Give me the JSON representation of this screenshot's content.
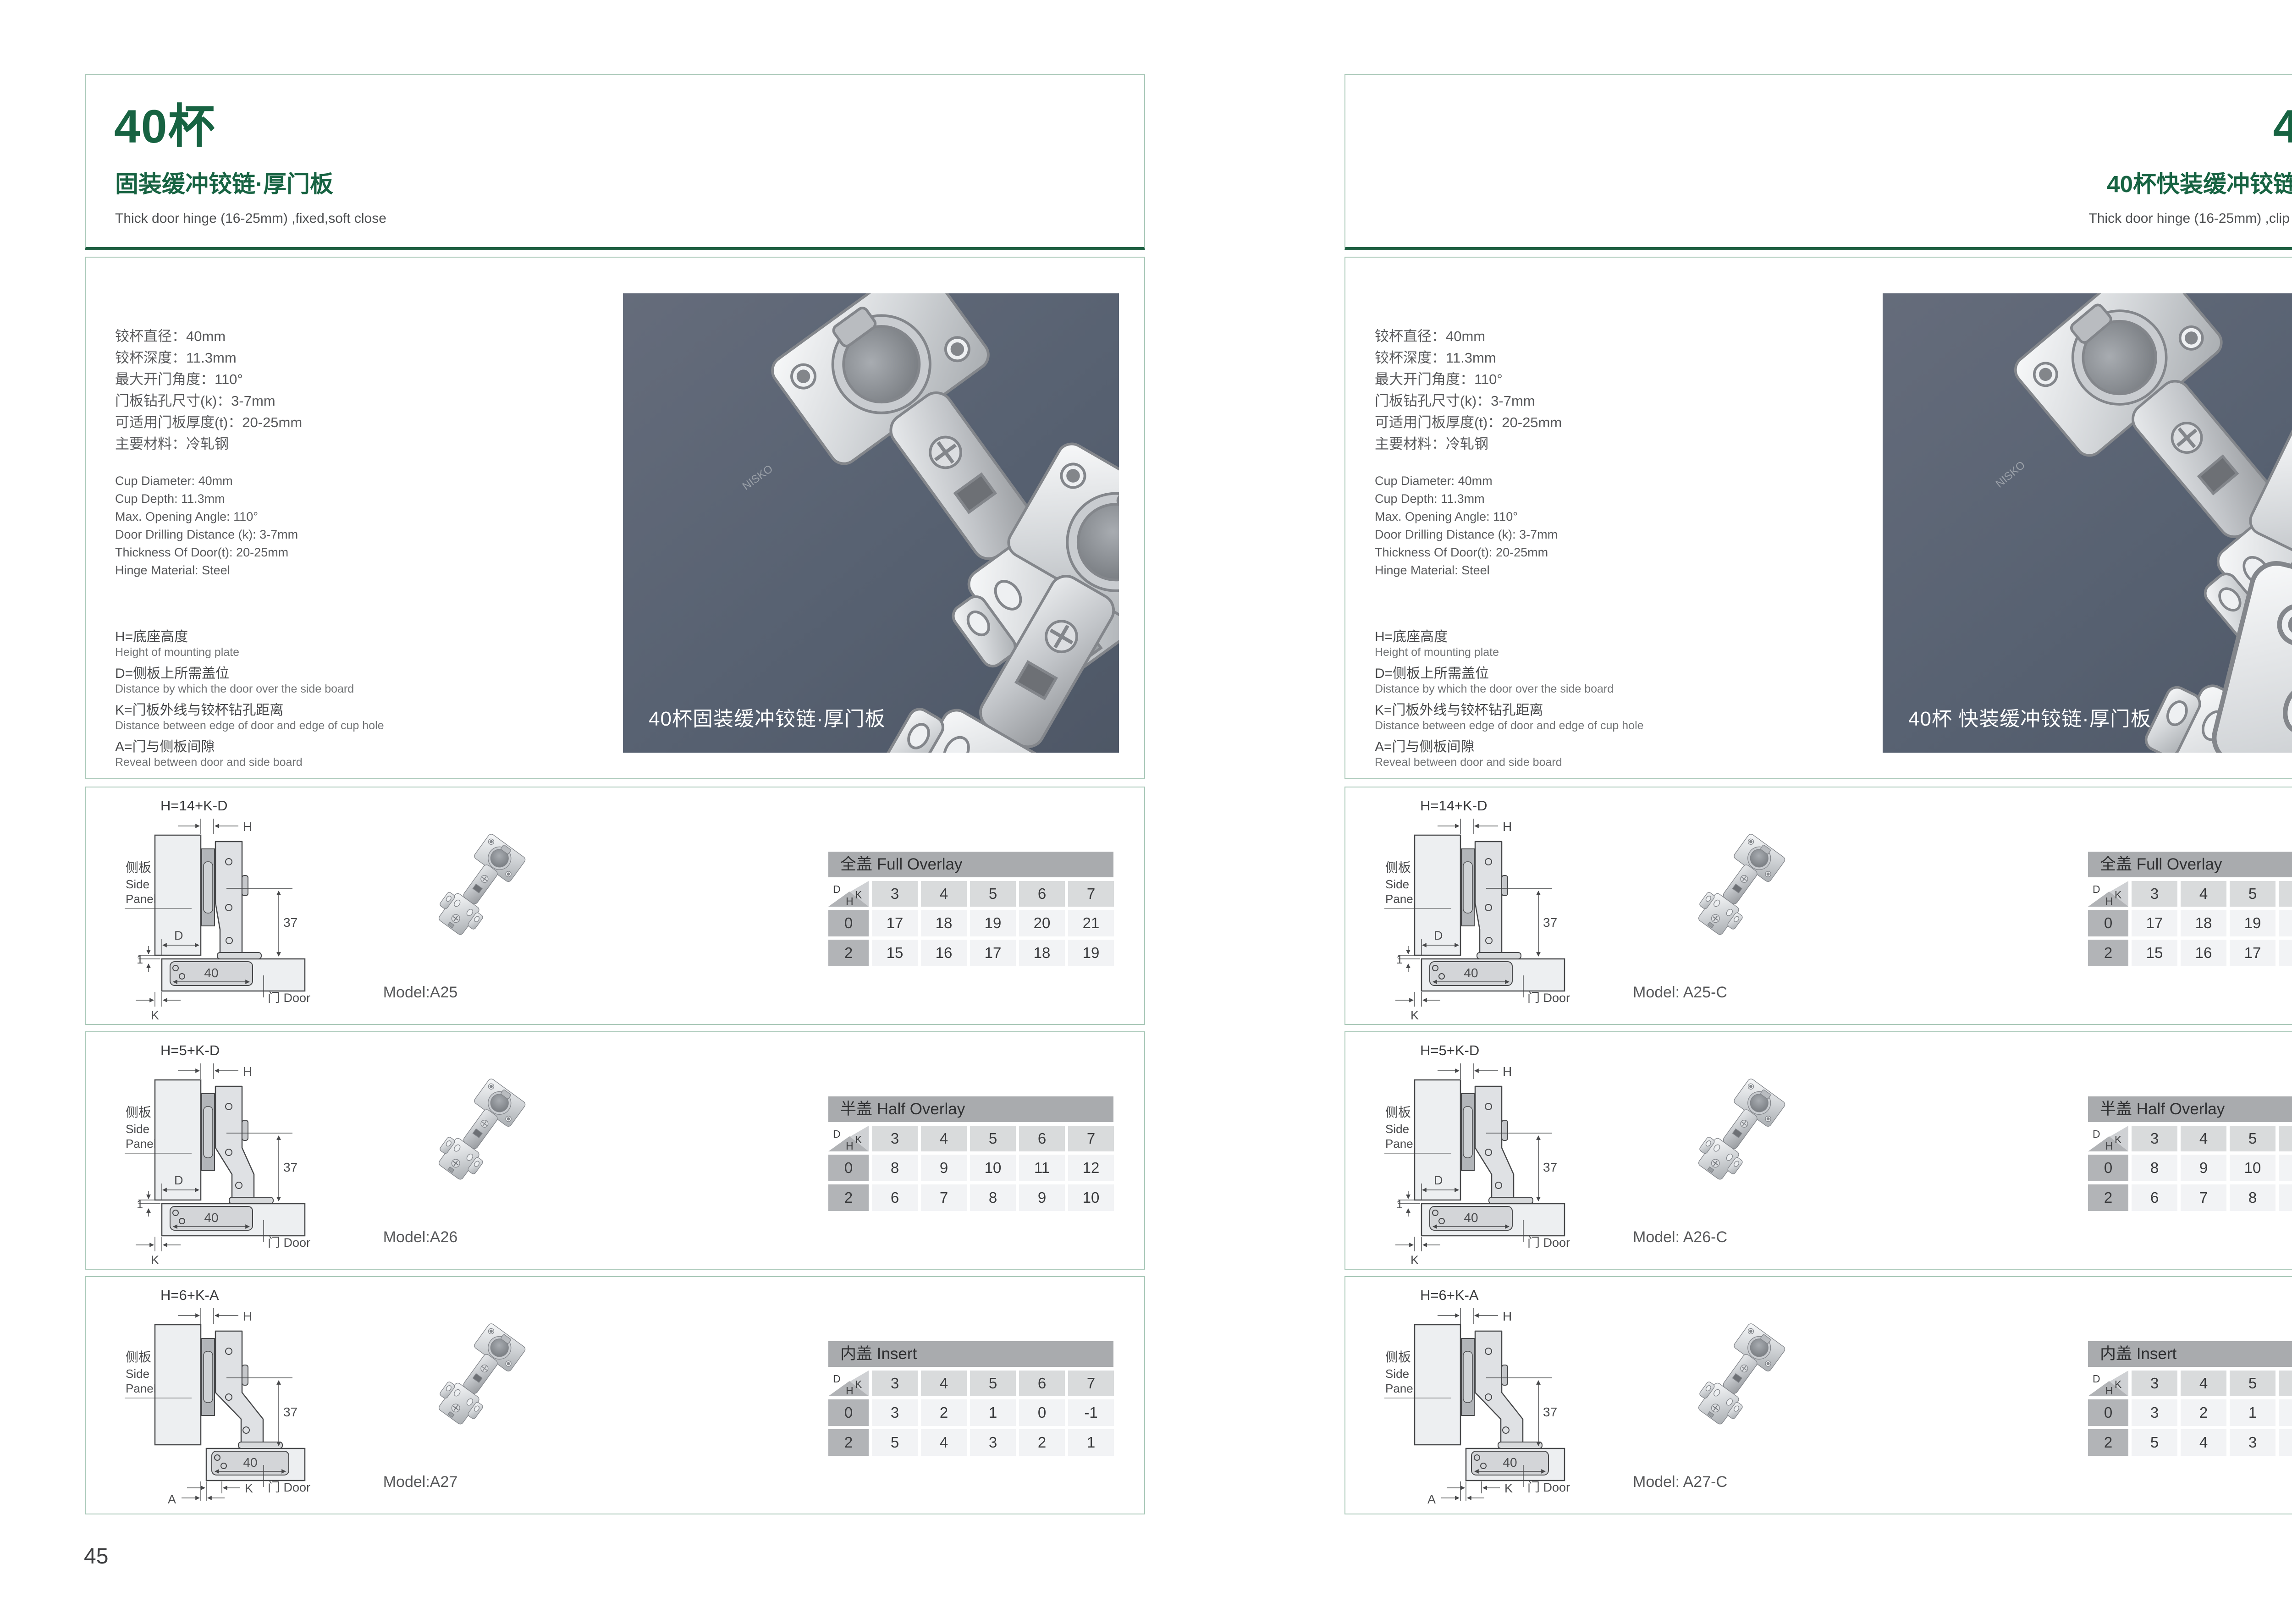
{
  "shared": {
    "brand_mark": "NISKO",
    "specs_zh": [
      "铰杯直径：40mm",
      "铰杯深度：11.3mm",
      "最大开门角度：110°",
      "门板钻孔尺寸(k)：3-7mm",
      "可适用门板厚度(t)：20-25mm",
      "主要材料：冷轧钢"
    ],
    "specs_en": [
      "Cup Diameter: 40mm",
      "Cup Depth: 11.3mm",
      "Max. Opening Angle: 110°",
      "Door Drilling Distance (k): 3-7mm",
      "Thickness Of Door(t): 20-25mm",
      "Hinge Material: Steel"
    ],
    "definitions": [
      {
        "zh": "H=底座高度",
        "en": "Height of mounting plate"
      },
      {
        "zh": "D=侧板上所需盖位",
        "en": "Distance by which the door over the side board"
      },
      {
        "zh": "K=门板外线与铰杯钻孔距离",
        "en": "Distance between edge of door and edge of cup hole"
      },
      {
        "zh": "A=门与侧板间隙",
        "en": "Reveal between door and side board"
      }
    ],
    "diagram": {
      "formulas": [
        "H=14+K-D",
        "H=5+K-D",
        "H=6+K-A"
      ],
      "side_panel_zh": "侧板",
      "side_panel_en1": "Side",
      "side_panel_en2": "Panel",
      "door_label": "门 Door",
      "h": "H",
      "d": "D",
      "k": "K",
      "a": "A",
      "dim37": "37",
      "dim40": "40",
      "dim1": "1"
    },
    "corner": {
      "d": "D",
      "k": "K",
      "h": "H"
    },
    "tables": [
      {
        "title": "全盖 Full Overlay",
        "k_values": [
          "3",
          "4",
          "5",
          "6",
          "7"
        ],
        "rows": [
          [
            "0",
            "17",
            "18",
            "19",
            "20",
            "21"
          ],
          [
            "2",
            "15",
            "16",
            "17",
            "18",
            "19"
          ]
        ]
      },
      {
        "title": "半盖 Half Overlay",
        "k_values": [
          "3",
          "4",
          "5",
          "6",
          "7"
        ],
        "rows": [
          [
            "0",
            "8",
            "9",
            "10",
            "11",
            "12"
          ],
          [
            "2",
            "6",
            "7",
            "8",
            "9",
            "10"
          ]
        ]
      },
      {
        "title": "内盖 Insert",
        "k_values": [
          "3",
          "4",
          "5",
          "6",
          "7"
        ],
        "rows": [
          [
            "0",
            "3",
            "2",
            "1",
            "0",
            "-1"
          ],
          [
            "2",
            "5",
            "4",
            "3",
            "2",
            "1"
          ]
        ]
      }
    ]
  },
  "left_page": {
    "title": "40杯",
    "subtitle": "固装缓冲铰链·厚门板",
    "tagline": "Thick door hinge (16-25mm) ,fixed,soft close",
    "photo_caption": "40杯固装缓冲铰链·厚门板",
    "models": [
      "Model:A25",
      "Model:A26",
      "Model:A27"
    ],
    "page_number": "45"
  },
  "right_page": {
    "title": "40杯",
    "subtitle": "40杯快装缓冲铰链·厚门板",
    "tagline": "Thick door hinge (16-25mm) ,clip on ,soft close",
    "photo_caption": "40杯 快装缓冲铰链·厚门板",
    "models": [
      "Model: A25-C",
      "Model: A26-C",
      "Model: A27-C"
    ],
    "page_number": "46"
  }
}
